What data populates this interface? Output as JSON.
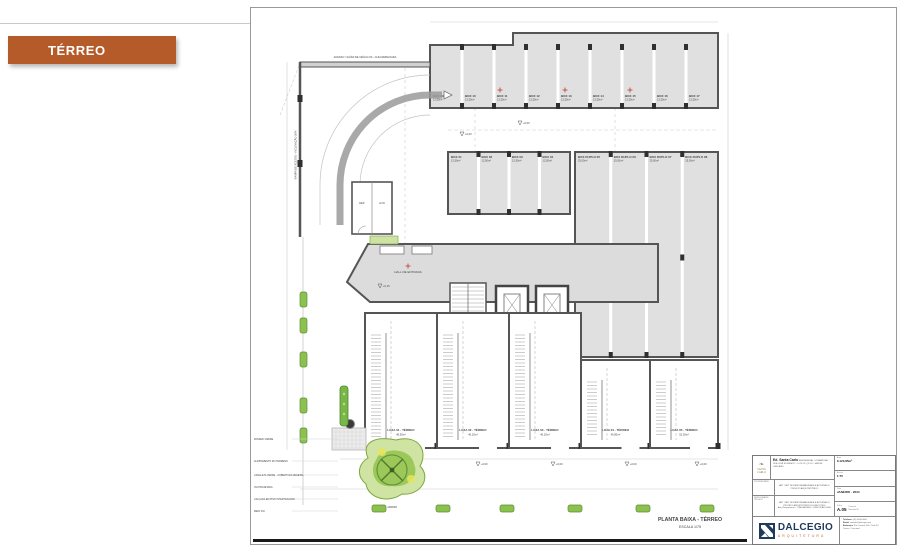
{
  "banner": {
    "label": "TÉRREO"
  },
  "plan": {
    "caption": {
      "title": "PLANTA BAIXA - TÉRREO",
      "scale": "ESCALA 1/75"
    },
    "ramp": {
      "label_top": "ACESSO / SAÍDA DE VEÍCULOS - GUIA REBAIXADA",
      "label_side": "RAMPA DE ACESSO - INCLINAÇÃO 20%"
    },
    "rooms": {
      "hall": "HALL DE ENTRADA",
      "stairs": "ESCADA",
      "elev1": "ELEV. 01",
      "elev2": "ELEV. 02",
      "dep1": "DEP.",
      "dep2": "LIXO",
      "garden": "JARDIM"
    },
    "box_row1": [
      {
        "label": "BOX 09",
        "area": "12,50m²"
      },
      {
        "label": "BOX 10",
        "area": "12,50m²"
      },
      {
        "label": "BOX 11",
        "area": "12,50m²"
      },
      {
        "label": "BOX 12",
        "area": "12,50m²"
      },
      {
        "label": "BOX 13",
        "area": "12,50m²"
      },
      {
        "label": "BOX 14",
        "area": "12,50m²"
      },
      {
        "label": "BOX 15",
        "area": "12,50m²"
      },
      {
        "label": "BOX 16",
        "area": "12,50m²"
      },
      {
        "label": "BOX 17",
        "area": "12,50m²"
      }
    ],
    "box_row2": [
      {
        "label": "BOX 01",
        "area": "12,50m²"
      },
      {
        "label": "BOX 02",
        "area": "12,50m²"
      },
      {
        "label": "BOX 03",
        "area": "12,50m²"
      },
      {
        "label": "BOX 04",
        "area": "12,50m²"
      }
    ],
    "box_duplo": [
      {
        "label": "BOX DUPLO 05",
        "area": "25,00m²"
      },
      {
        "label": "BOX DUPLO 06",
        "area": "25,00m²"
      },
      {
        "label": "BOX DUPLO 07",
        "area": "25,00m²"
      },
      {
        "label": "BOX DUPLO 08",
        "area": "25,00m²"
      }
    ],
    "lojas": [
      {
        "label": "LOJA 01 - TÉRREO",
        "area": "48,50m²"
      },
      {
        "label": "LOJA 02 - TÉRREO",
        "area": "45,20m²"
      },
      {
        "label": "LOJA 03 - TÉRREO",
        "area": "45,20m²"
      },
      {
        "label": "LOJA 04 - TÉRREO",
        "area": "46,80m²"
      },
      {
        "label": "LOJA 05 - TÉRREO",
        "area": "52,30m²"
      }
    ],
    "levels": [
      "+0,00",
      "+0,15"
    ],
    "margin_notes": [
      "PASSEIO VERDE",
      "ALINHAMENTO DO TERRENO",
      "CANALETA VERDE - COBERTURA VEGETAL",
      "VIA PROJETADA",
      "CALÇADA EM PISO INTERTRAVADO",
      "MEIO FIO"
    ]
  },
  "title_block": {
    "project": {
      "logo_laurel": "❧",
      "logo_line1": "SANTA",
      "logo_line2": "CARLO",
      "name": "Ed. Santa Carlo",
      "type": "RESIDENCIAL / COMERCIAL",
      "address1": "RUA JOSÉ BONIFÁCIO - LOTE 05, QD 02 - JARDIM",
      "address2": "CASCAVEL"
    },
    "fields": {
      "area_label": "Área",
      "area_value": "9.123,85m²",
      "escala_label": "Escala",
      "escala_value": "1:75",
      "data_label": "Data",
      "data_value": "JANEIRO - 2024",
      "folha_label": "Folha",
      "folha_value": "A.05",
      "folha_note1": "Prancha",
      "folha_note2": "Revisão 00"
    },
    "rows": {
      "r2_side": "PROPRIETÁRIO",
      "r2_text": "ART / RRT DE RESPONSABILIDADE E AUTORIA DO PROJETO ARQUITETÔNICO",
      "r3_side": "RESPONSÁVEL TÉCNICO",
      "r3_text1": "ART / RRT DE RESPONSABILIDADE E AUTORIA DO PROJETO ARQUITETÔNICO E EXECUTIVO",
      "r3_text2": "Arq. Responsável — CAU A00000-0 · EXECUÇÃO 00/00"
    },
    "brand": {
      "name": "DALCEGIO",
      "sub": "ARQUITETURA"
    },
    "contact": {
      "line1_b": "Telefone:",
      "line1": "(00) 0000-0000",
      "line2_b": "Email:",
      "line2": "contato@dalcegio.com",
      "line3_b": "Endereço:",
      "line3": "Rua Central, 000 - Sala 02,",
      "line4": "Centro - Cascavel"
    }
  }
}
